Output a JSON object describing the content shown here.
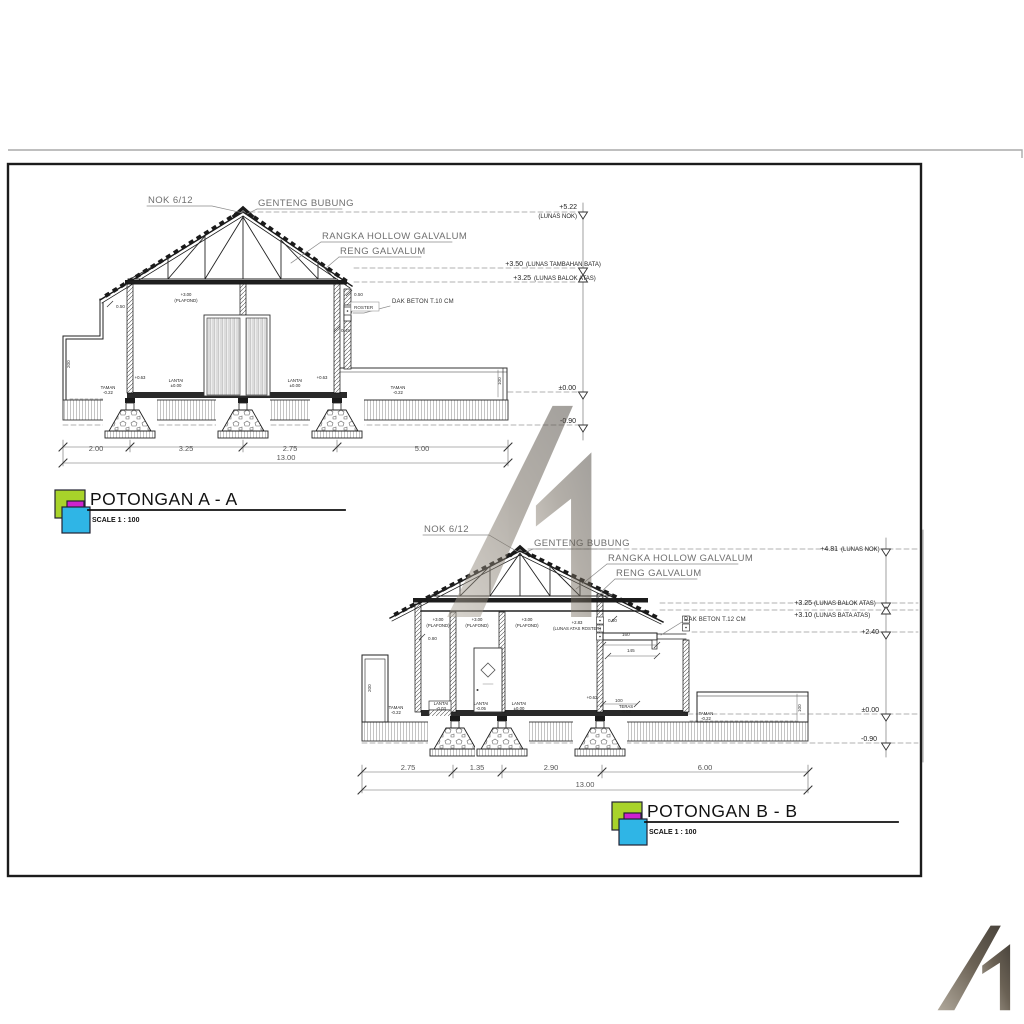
{
  "section_a": {
    "title": "POTONGAN A - A",
    "scale": "SCALE 1 : 100",
    "callouts": {
      "nok": "NOK 6/12",
      "genteng": "GENTENG BUBUNG",
      "rangka": "RANGKA HOLLOW GALVALUM",
      "reng": "RENG GALVALUM",
      "dak": "DAK BETON T.10 CM",
      "roster": "ROSTER"
    },
    "levels": [
      {
        "value": "+5.22",
        "note": "(LUNAS NOK)"
      },
      {
        "value": "+3.50",
        "note": "(LUNAS TAMBAHAN BATA)"
      },
      {
        "value": "+3.25",
        "note": "(LUNAS BALOK ATAS)"
      },
      {
        "value": "±0.00",
        "note": ""
      },
      {
        "value": "-0.90",
        "note": ""
      }
    ],
    "interior": {
      "plafond": "+3.00",
      "plafond_note": "(PLAFOND)",
      "sill": "+0.63",
      "lantai": "LANTAI",
      "lantai_lvl": "±0.00",
      "taman": "TAMAN",
      "taman_lvl": "-0.22"
    },
    "mini_dims": {
      "d050l": "0.50",
      "d050r": "0.50",
      "d045": "0.45",
      "h200": "200",
      "h100": "100"
    },
    "dims": [
      "2.00",
      "3.25",
      "2.75",
      "5.00"
    ],
    "dim_total": "13.00"
  },
  "section_b": {
    "title": "POTONGAN B - B",
    "scale": "SCALE 1 : 100",
    "callouts": {
      "nok": "NOK 6/12",
      "genteng": "GENTENG BUBUNG",
      "rangka": "RANGKA HOLLOW GALVALUM",
      "reng": "RENG GALVALUM",
      "dak": "DAK BETON T.12 CM"
    },
    "levels": [
      {
        "value": "+4.81",
        "note": "(LUNAS NOK)"
      },
      {
        "value": "+3.25",
        "note": "(LUNAS BALOK ATAS)"
      },
      {
        "value": "+3.10",
        "note": "(LUNAS BATA ATAS)"
      },
      {
        "value": "+2.40",
        "note": ""
      },
      {
        "value": "±0.00",
        "note": ""
      },
      {
        "value": "-0.90",
        "note": ""
      }
    ],
    "interior": {
      "plafond": "+3.00",
      "plafond_note": "(PLAFOND)",
      "roster_lvl": "+2.83",
      "roster_note": "(LUNAS ATAS ROSTER)",
      "sill": "+0.63",
      "lantai": "LANTAI",
      "lantai1": "-0.03",
      "lantai2": "-0.05",
      "lantai3": "±0.00",
      "teras": "TERAS",
      "teras_lvl": "-0.02",
      "taman": "TAMAN",
      "taman_lvl": "-0.22"
    },
    "mini_dims": {
      "d080": "0.80",
      "d050": "0.50",
      "d160": "160",
      "d145": "145",
      "d100": "100",
      "h200": "200",
      "h100": "100"
    },
    "dims": [
      "2.75",
      "1.35",
      "2.90",
      "6.00"
    ],
    "dim_total": "13.00"
  },
  "logo_colors": {
    "green": "#a8d32a",
    "magenta": "#cd22cf",
    "cyan": "#2fb5e6",
    "gray_dark": "#4a443c",
    "gray_light": "#b0a89b"
  }
}
